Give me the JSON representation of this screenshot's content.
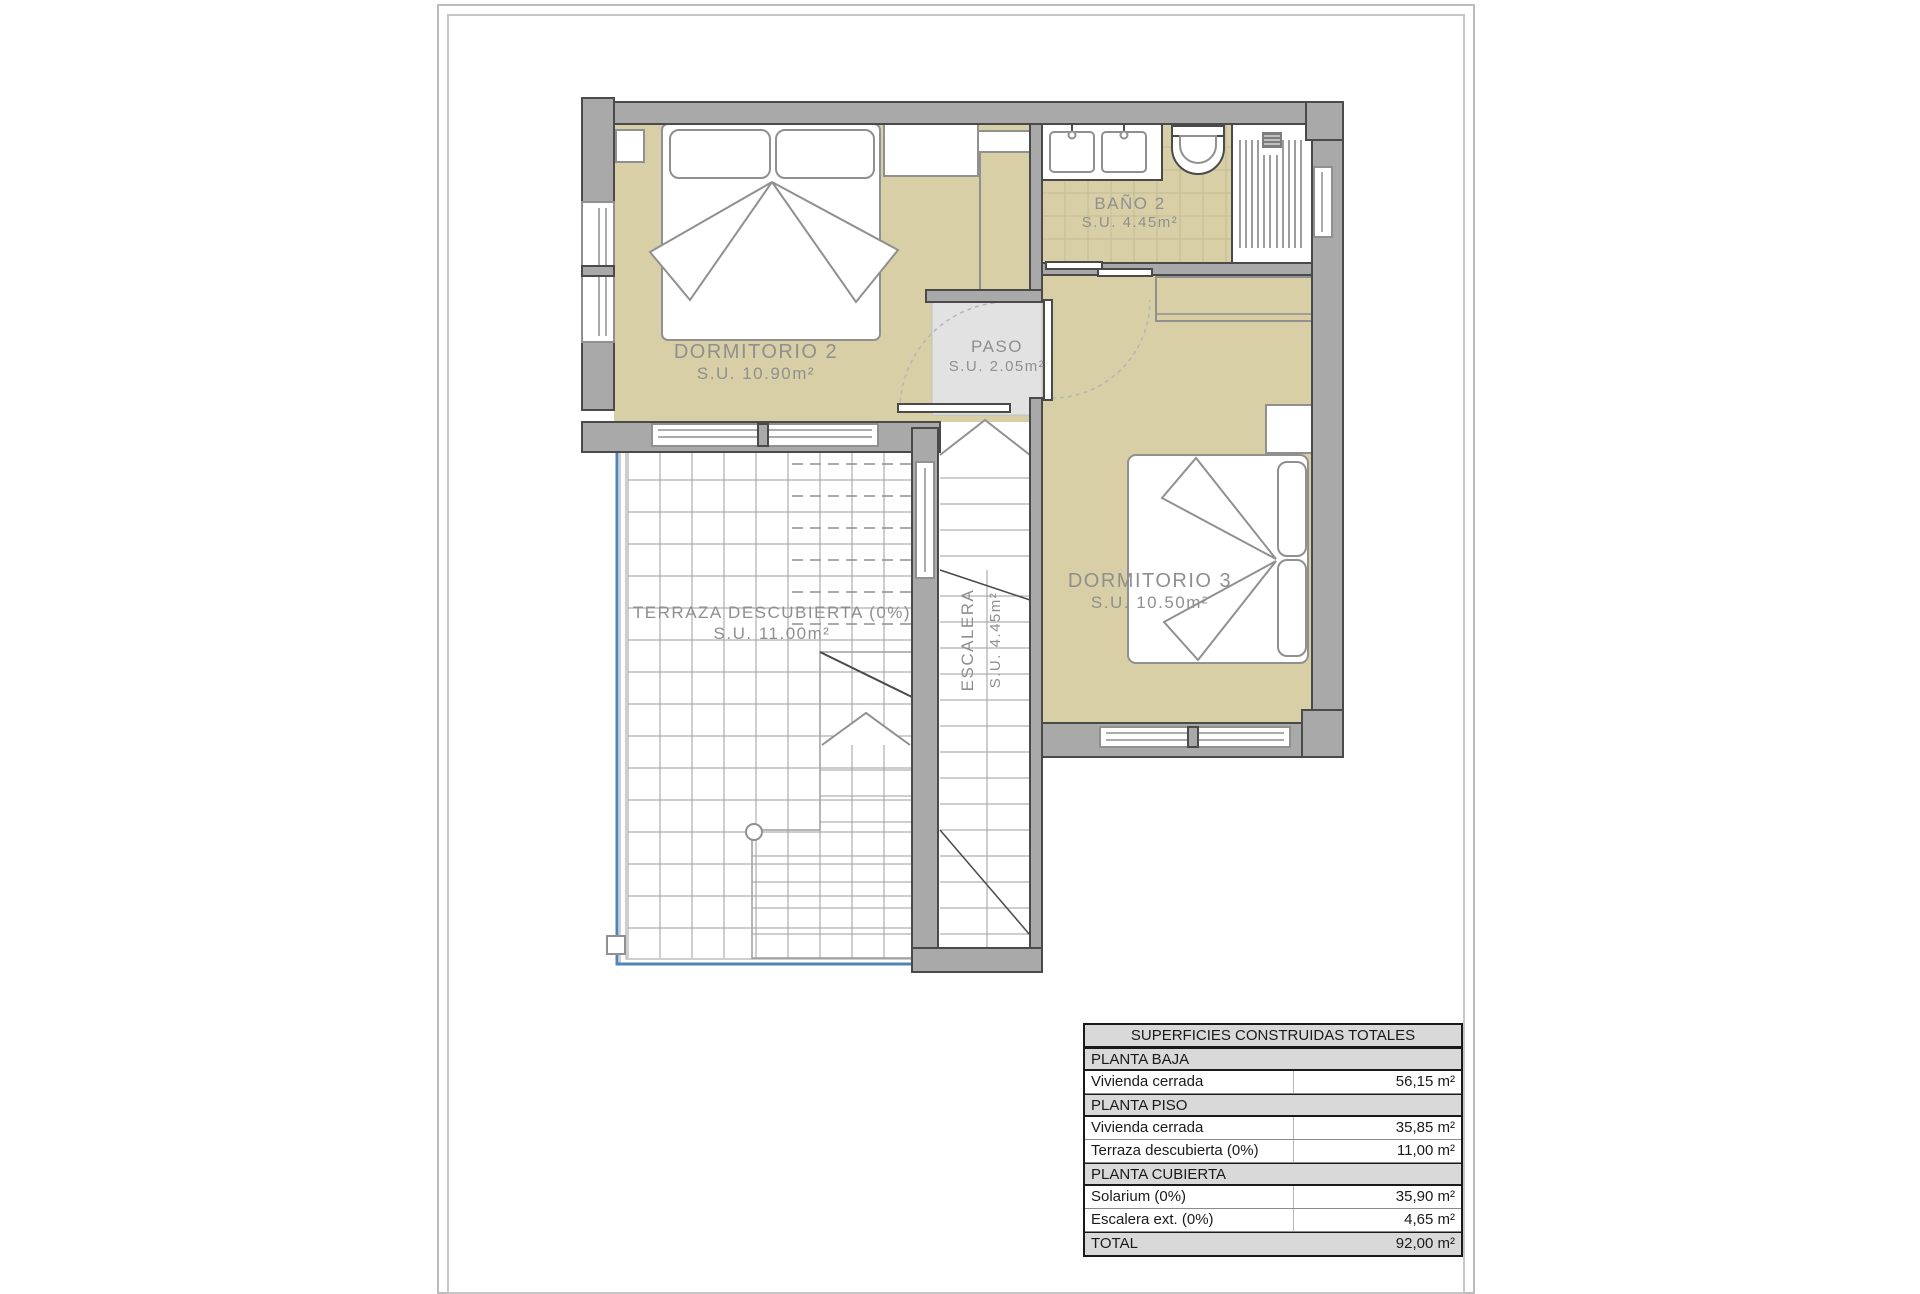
{
  "plan": {
    "rooms": {
      "dormitorio2": {
        "name": "DORMITORIO 2",
        "area": "S.U. 10.90m²"
      },
      "bano2": {
        "name": "BAÑO 2",
        "area": "S.U. 4.45m²"
      },
      "paso": {
        "name": "PASO",
        "area": "S.U. 2.05m²"
      },
      "dormitorio3": {
        "name": "DORMITORIO 3",
        "area": "S.U. 10.50m²"
      },
      "terraza": {
        "name": "TERRAZA DESCUBIERTA (0%)",
        "area": "S.U. 11.00m²"
      },
      "escalera": {
        "name": "ESCALERA",
        "area": "S.U. 4.45m²"
      }
    },
    "colors": {
      "room_fill": "#d8cfa6",
      "wall_fill": "#a9a9a9",
      "wall_stroke": "#4a4a4a",
      "paso_fill": "#e2e2e2",
      "terrace_line": "#4f86b5",
      "label": "#8f8f8f"
    }
  },
  "areas_table": {
    "title": "SUPERFICIES CONSTRUIDAS TOTALES",
    "rows": [
      {
        "kind": "section",
        "label": "PLANTA BAJA",
        "value": ""
      },
      {
        "kind": "data",
        "label": "Vivienda cerrada",
        "value": "56,15 m²"
      },
      {
        "kind": "section",
        "label": "PLANTA PISO",
        "value": ""
      },
      {
        "kind": "data",
        "label": "Vivienda cerrada",
        "value": "35,85 m²"
      },
      {
        "kind": "data",
        "label": "Terraza descubierta (0%)",
        "value": "11,00 m²"
      },
      {
        "kind": "section",
        "label": "PLANTA CUBIERTA",
        "value": ""
      },
      {
        "kind": "data",
        "label": "Solarium (0%)",
        "value": "35,90 m²"
      },
      {
        "kind": "data",
        "label": "Escalera ext. (0%)",
        "value": "4,65 m²"
      },
      {
        "kind": "total",
        "label": "TOTAL",
        "value": "92,00 m²"
      }
    ]
  }
}
